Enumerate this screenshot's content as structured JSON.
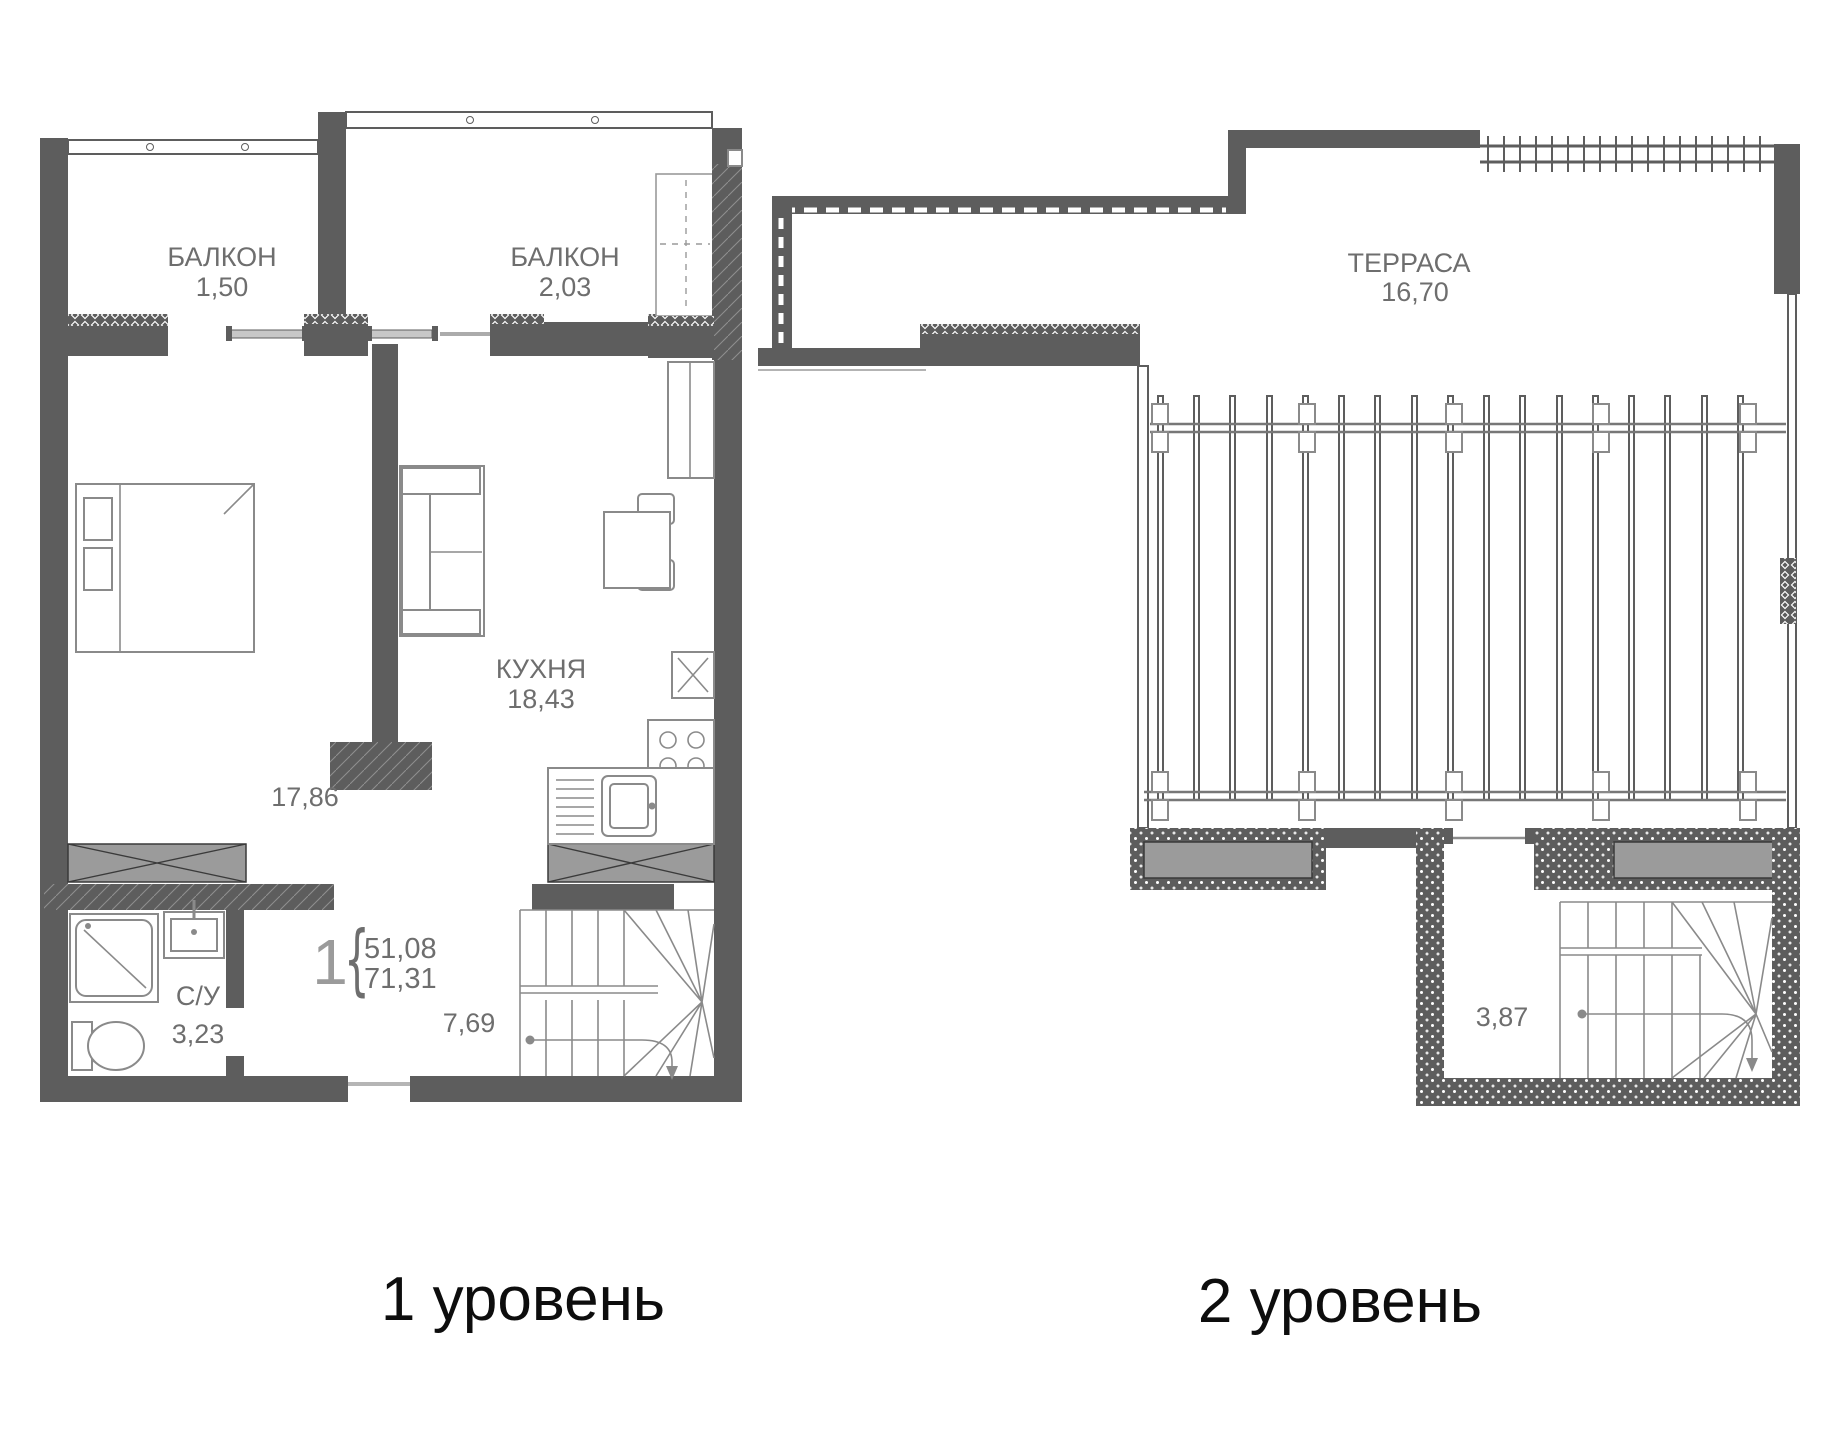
{
  "document": {
    "kind": "apartment floor plan, two levels"
  },
  "colors": {
    "wall": "#5d5d5d",
    "furniture_line": "#8a8a8a",
    "label_text": "#6e6e6e",
    "hatch_fill": "#9b9b9b",
    "title_text": "#0d0d0d"
  },
  "levels": [
    {
      "title": "1 уровень",
      "apartment_badge": {
        "number": "1",
        "brace": "{",
        "living_area": "51,08",
        "total_area": "71,31"
      },
      "rooms": [
        {
          "key": "balcony-1",
          "name": "БАЛКОН",
          "area": "1,50"
        },
        {
          "key": "balcony-2",
          "name": "БАЛКОН",
          "area": "2,03"
        },
        {
          "key": "kitchen",
          "name": "КУХНЯ",
          "area": "18,43"
        },
        {
          "key": "bedroom",
          "name": "",
          "area": "17,86"
        },
        {
          "key": "bathroom",
          "name": "С/У",
          "area": "3,23"
        },
        {
          "key": "hall",
          "name": "",
          "area": "7,69"
        }
      ]
    },
    {
      "title": "2 уровень",
      "rooms": [
        {
          "key": "terrace",
          "name": "ТЕРРАСА",
          "area": "16,70"
        },
        {
          "key": "stair-room",
          "name": "",
          "area": "3,87"
        }
      ]
    }
  ]
}
